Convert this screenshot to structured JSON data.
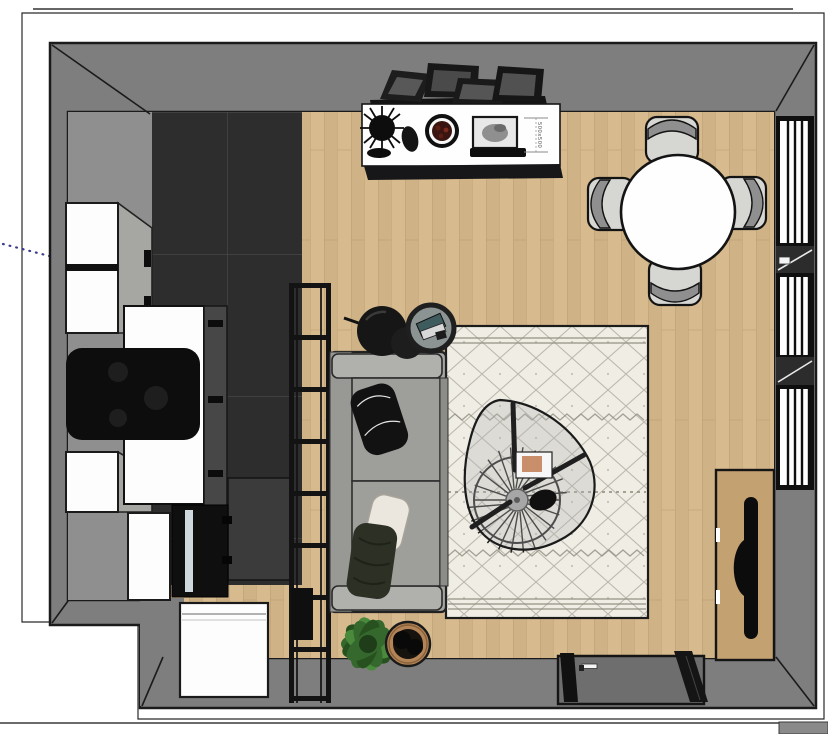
{
  "annotation": {
    "dimension_label": "500x500"
  },
  "colors": {
    "wall": "#7e7e7e",
    "wallLine": "#1b1b1b",
    "wood": "#d7ba8d",
    "woodLine": "#b1946b",
    "tile": "#2d2d2d",
    "tileLine": "#4a4a4a",
    "cabinet": "#fdfdfd",
    "counterFace": "#474747",
    "sofa": "#a5a5a2",
    "sofaSeat": "#9e9e9b",
    "sofaArm": "#b0b0ad",
    "rugBase": "#f0ede5",
    "rugInk": "#908d81",
    "ladder": "#131313",
    "black": "#0d0d0d",
    "furnWood": "#c3a171",
    "plantGreen": "#35682c",
    "plantDark": "#27521f",
    "plantLight": "#4a8a3c",
    "basketTan": "#b28457",
    "chairSeat": "#d6d6d3",
    "chairBack": "#8f8f8f",
    "guideBlue": "#3c3c8e",
    "bowlRed": "#5a1d12",
    "teal": "#3e5b5e"
  },
  "objects": [
    "room-walls",
    "wood-floor",
    "tile-floor",
    "window-right",
    "entry-door",
    "kitchen-upper-cabinets",
    "kitchen-lower-cabinets",
    "kitchen-counter",
    "cooktop",
    "appliance-column",
    "washing-machine",
    "ladder-shelf",
    "speaker-box",
    "sofa",
    "black-pillow",
    "white-pillow",
    "green-pillow",
    "pouf-large",
    "pouf-small",
    "side-table",
    "berber-rug",
    "coffee-table",
    "rattan-tray-base",
    "coffee-table-book",
    "dining-table",
    "dining-chair-north",
    "dining-chair-south",
    "dining-chair-east",
    "dining-chair-west",
    "console-table",
    "leaning-picture-frames",
    "console-plant",
    "decor-vase",
    "decor-bowl",
    "photo-frame",
    "dimension-annotation",
    "tv-sideboard",
    "television",
    "potted-plant",
    "storage-basket",
    "guide-dots",
    "corner-block"
  ]
}
